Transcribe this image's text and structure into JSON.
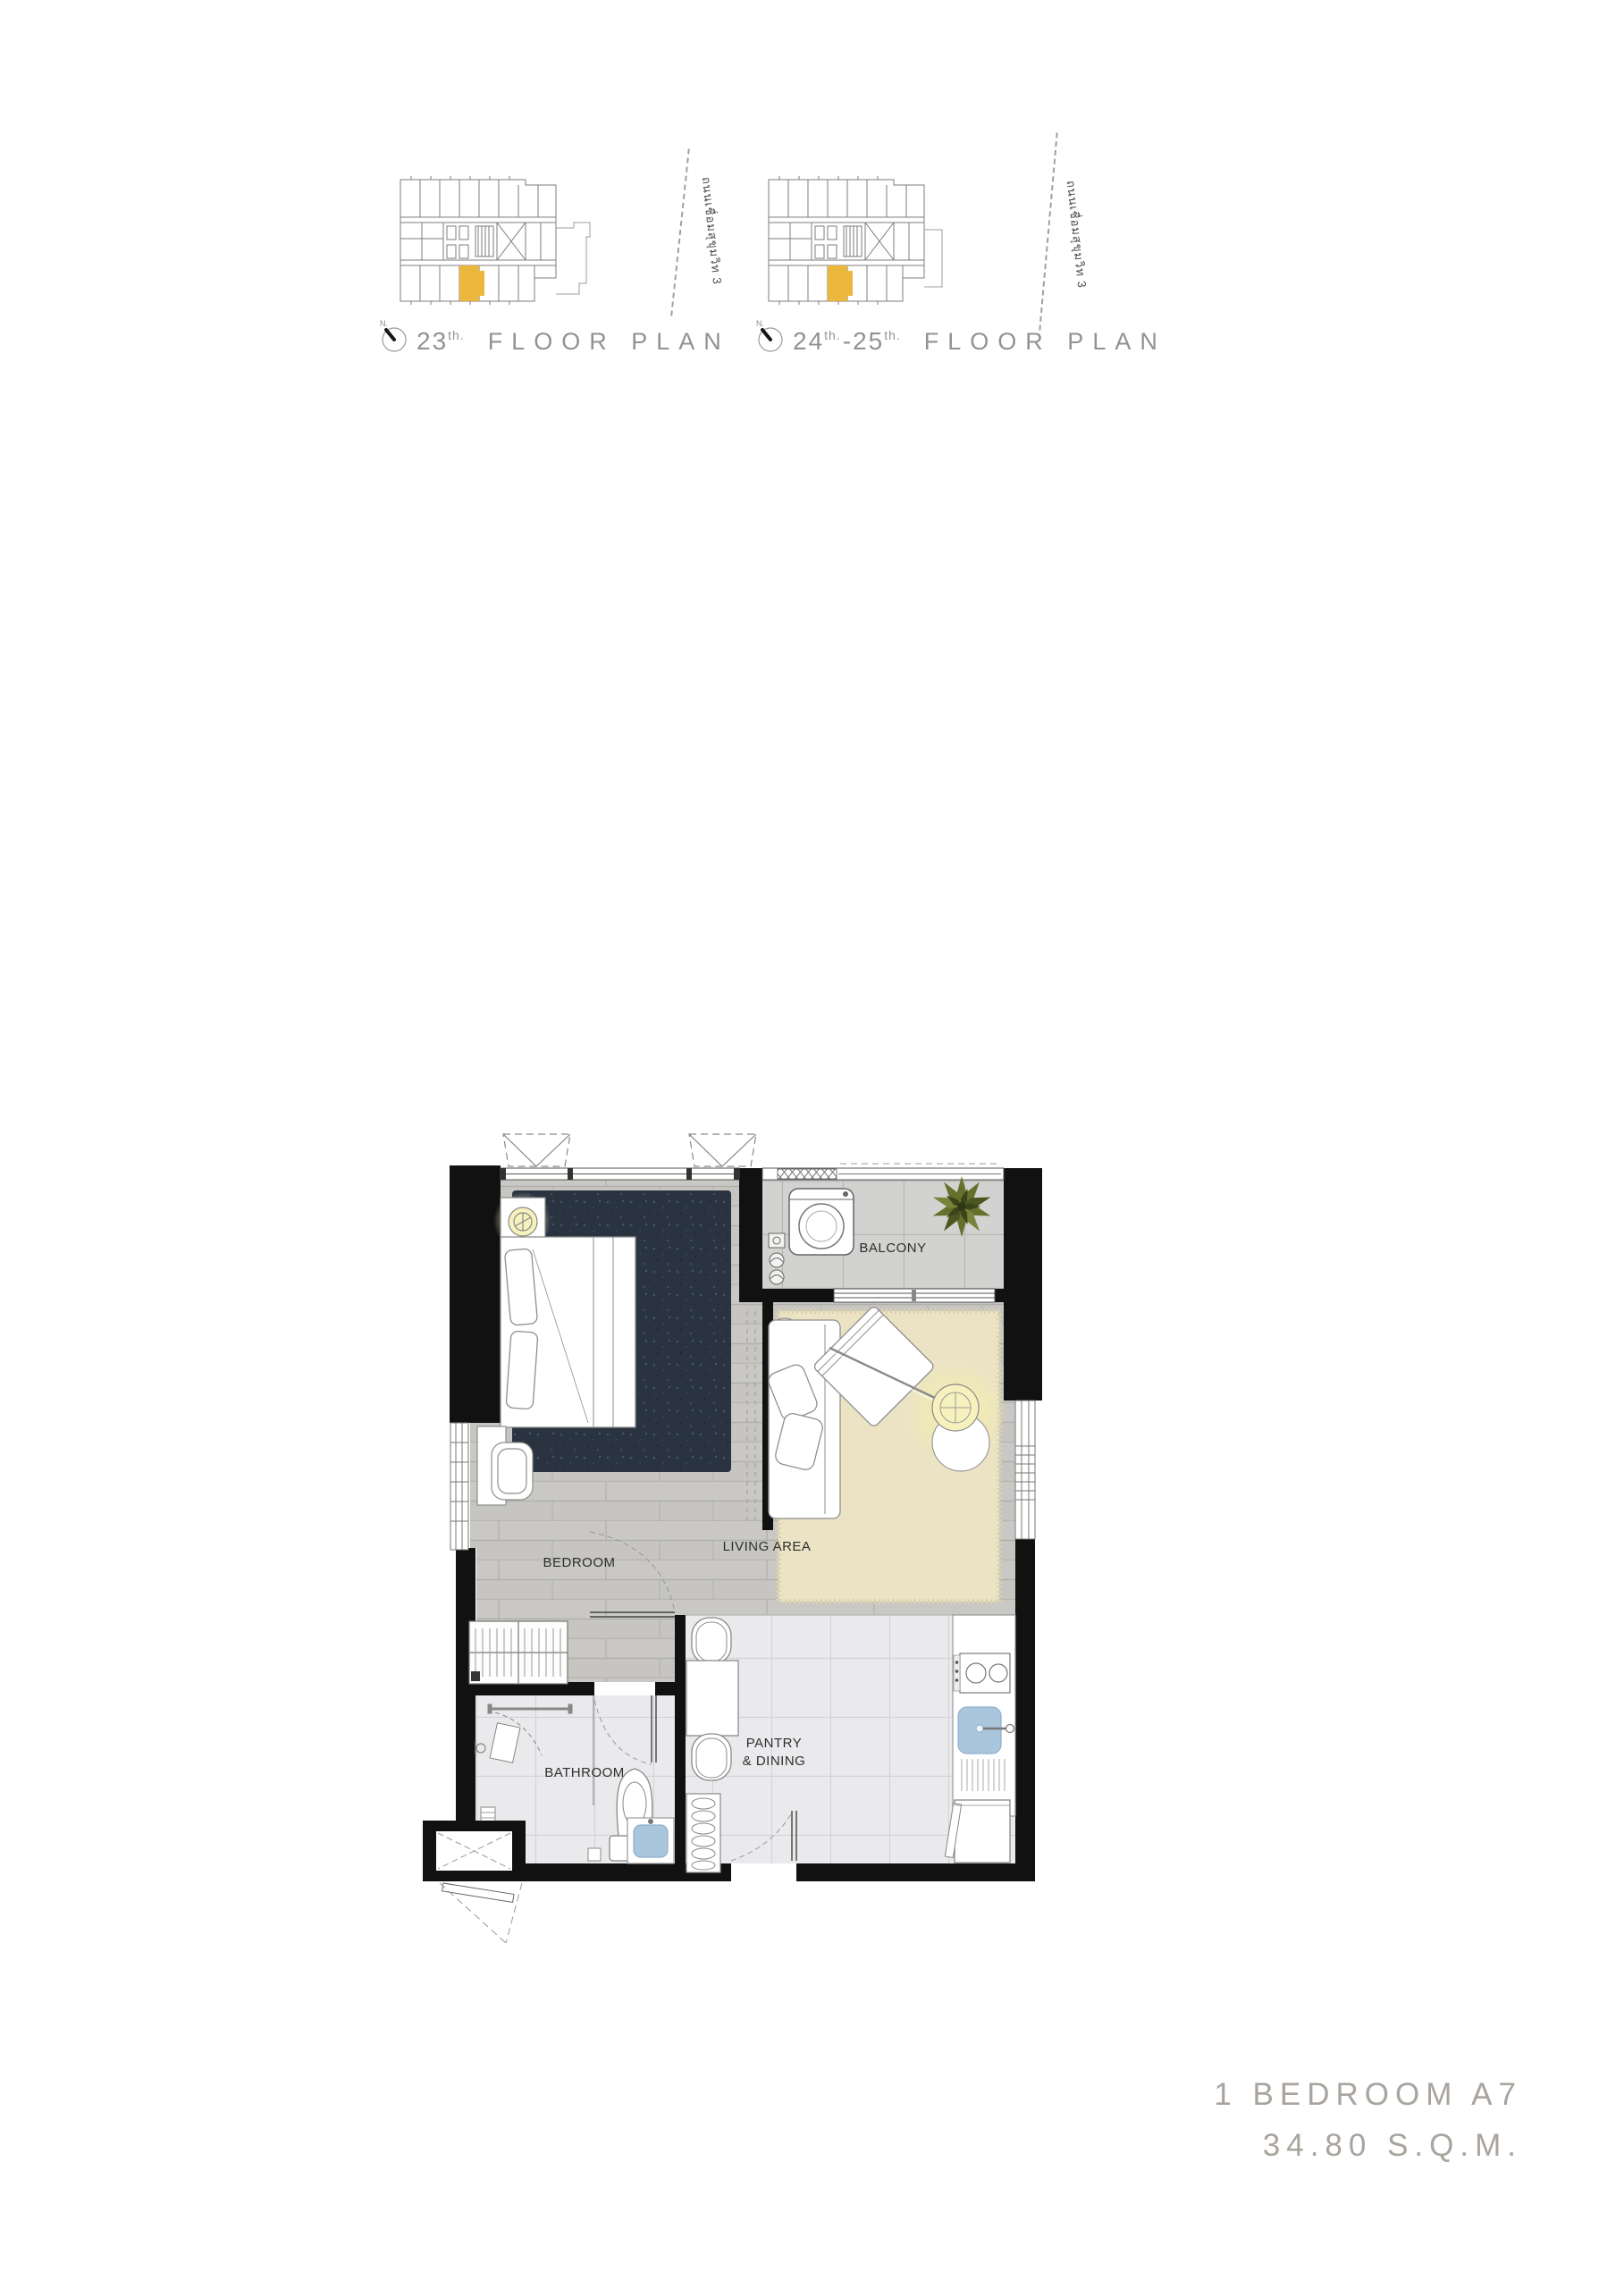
{
  "site_plans": {
    "plan1": {
      "north": "N.",
      "floor": "23",
      "floor_suffix": "th.",
      "title": "FLOOR PLAN",
      "road": "ถนนเชื่อมสุขุมวิท 3"
    },
    "plan2": {
      "north": "N.",
      "floor_start": "24",
      "suffix_start": "th.",
      "separator": "-",
      "floor_end": "25",
      "suffix_end": "th.",
      "title": "FLOOR PLAN",
      "road": "ถนนเชื่อมสุขุมวิท 3"
    }
  },
  "unit_plan": {
    "labels": {
      "balcony": "BALCONY",
      "living_area": "LIVING AREA",
      "bedroom": "BEDROOM",
      "bathroom": "BATHROOM",
      "pantry_line1": "PANTRY",
      "pantry_line2": "& DINING"
    }
  },
  "unit_summary": {
    "type": "1 BEDROOM A7",
    "area": "34.80 S.Q.M."
  },
  "colors": {
    "unit_highlight": "#ECB73D",
    "walls": "#111111",
    "wood_floor": "#C9C8C4",
    "bedroom_rug": "#2A3440",
    "living_rug": "#ECE4C6",
    "balcony_tile": "#D3D3D1",
    "bath_tile": "#EAEAED",
    "sink_blue": "#AAC6DD",
    "plant_green": "#66702C",
    "lamp_glow": "#F2E9A8",
    "summary_text": "#A9A49E",
    "drawing_grey": "#8F8F8F"
  }
}
